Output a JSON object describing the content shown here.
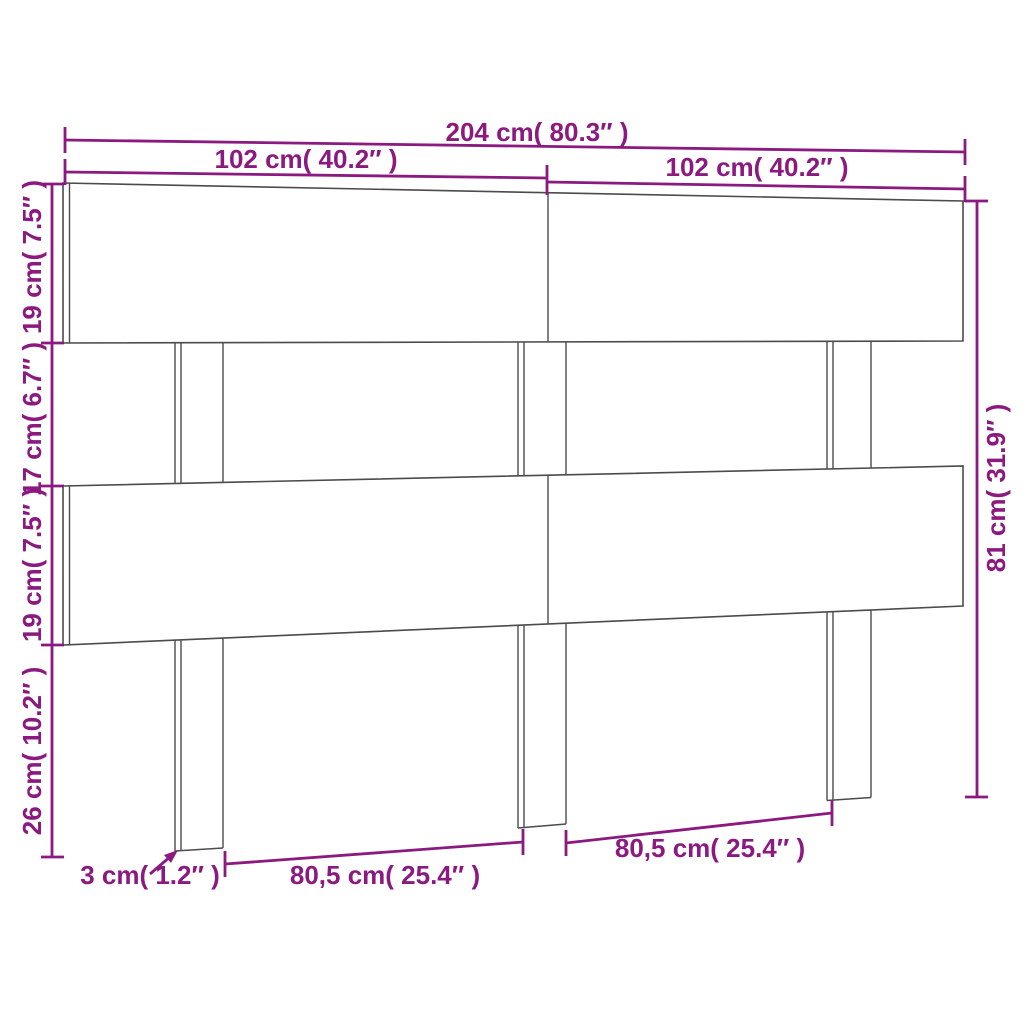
{
  "diagram": {
    "type": "product-dimension-drawing",
    "subject": "headboard with three slats and three legs, perspective line drawing",
    "colors": {
      "dimension": "#8C1980",
      "outline": "#4B4B4B",
      "background": "#FFFFFF"
    },
    "labels": {
      "total_width": "204 cm( 80.3″ )",
      "left_half_width": "102 cm( 40.2″ )",
      "right_half_width": "102 cm( 40.2″ )",
      "top_board_height": "19 cm( 7.5″ )",
      "gap_height": "17 cm( 6.7″ )",
      "middle_board_height": "19 cm( 7.5″ )",
      "bottom_section_height": "26 cm( 10.2″ )",
      "total_height": "81 cm( 31.9″ )",
      "board_thickness": "3 cm( 1.2″ )",
      "left_leg_spacing": "80,5 cm( 25.4″ )",
      "right_leg_spacing": "80,5 cm( 25.4″ )"
    }
  }
}
